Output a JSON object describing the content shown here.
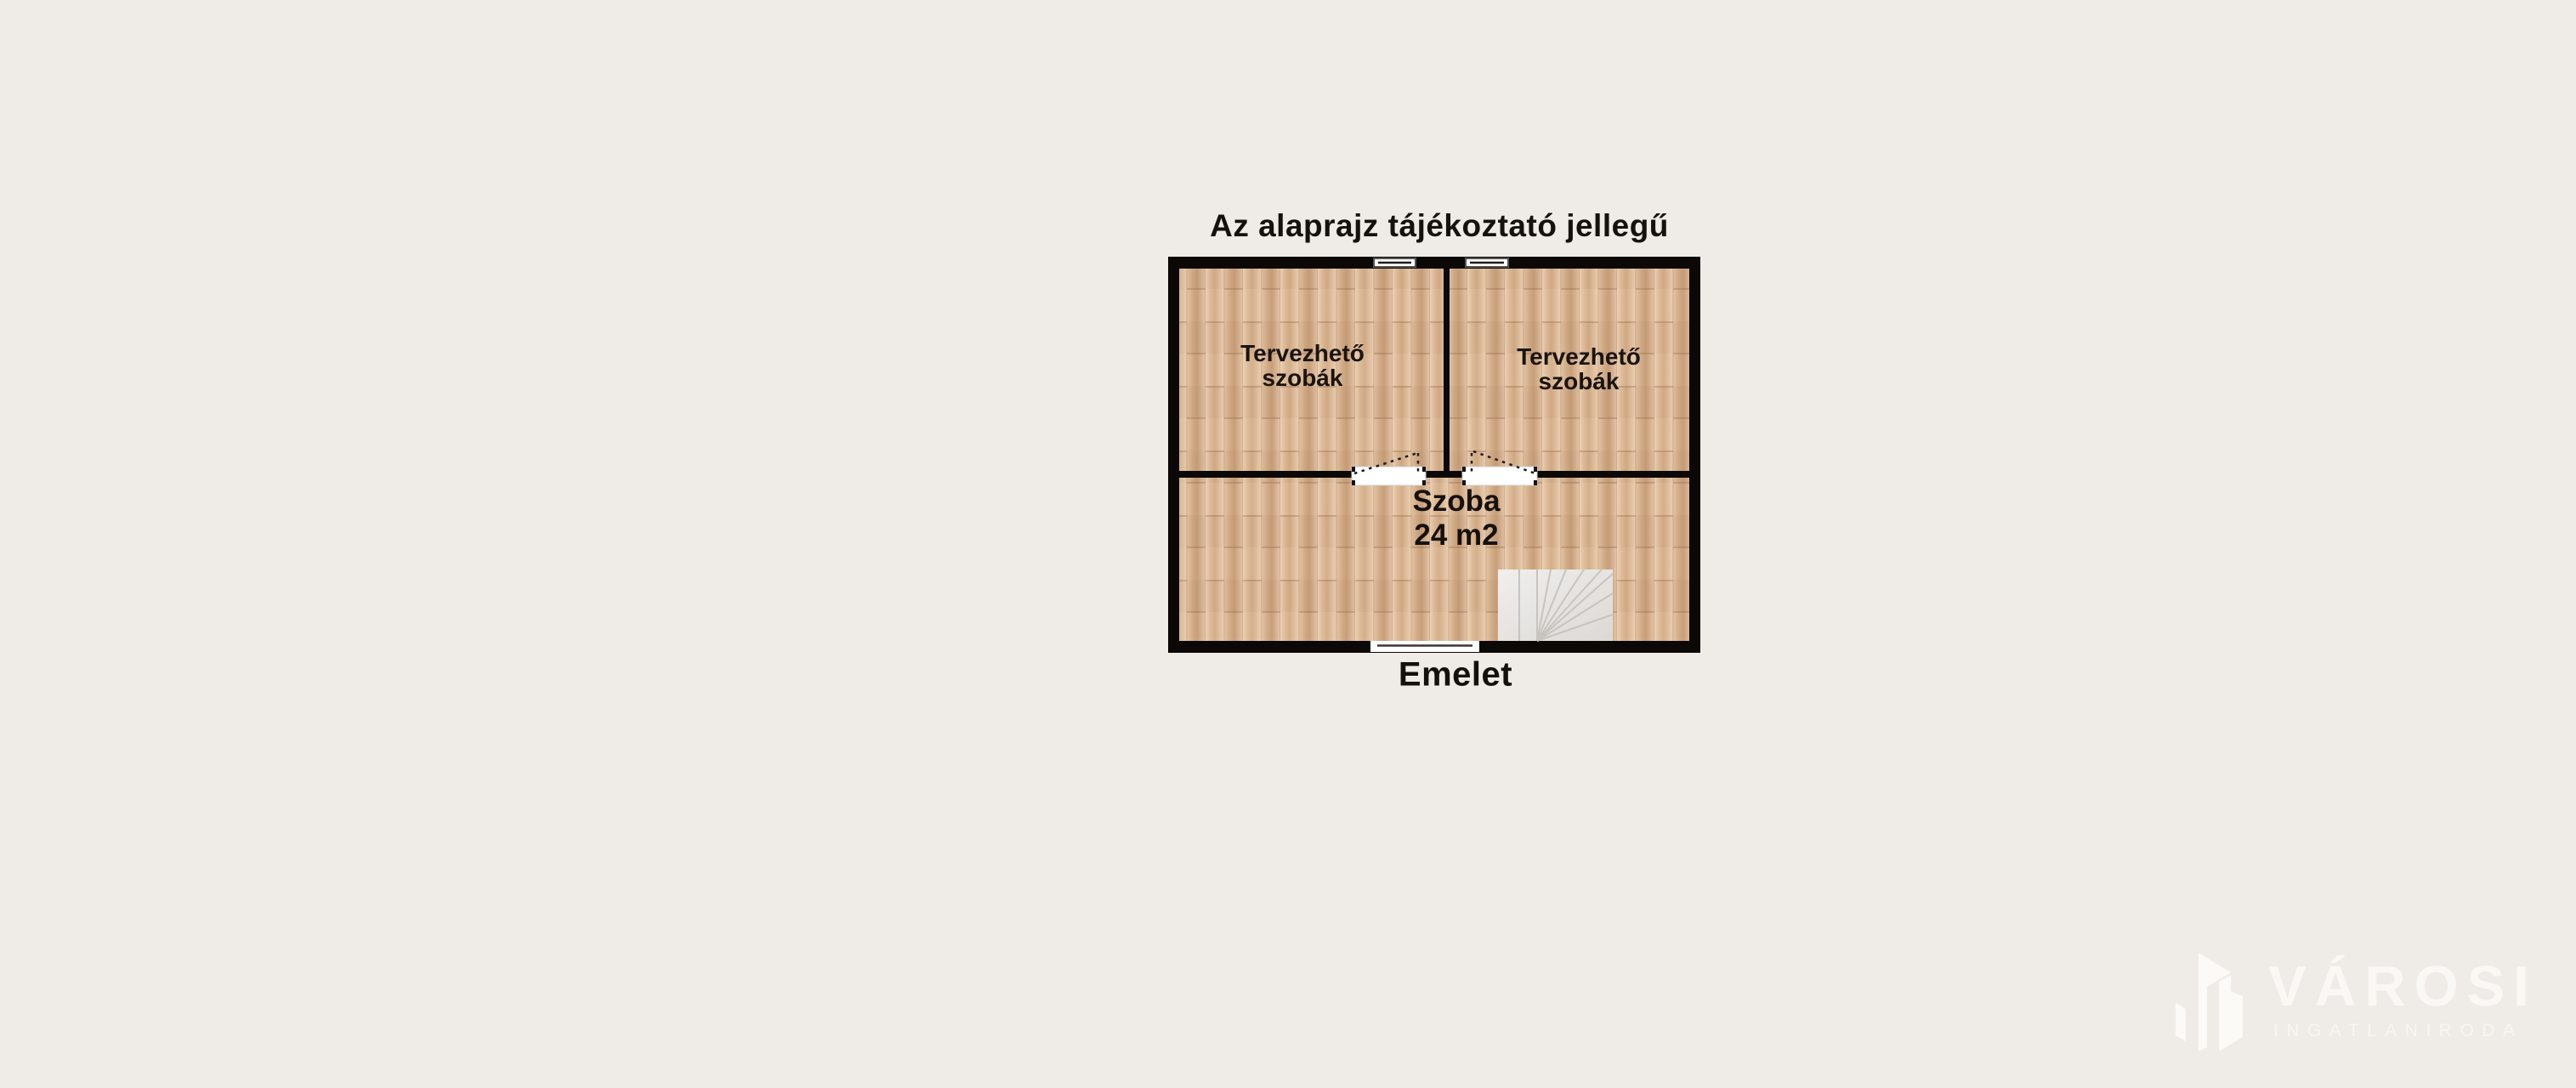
{
  "title": "Az alaprajz tájékoztató jellegű",
  "plan": {
    "floor_label": "Emelet",
    "room_top_left": {
      "line1": "Tervezhető",
      "line2": "szobák"
    },
    "room_top_right": {
      "line1": "Tervezhető",
      "line2": "szobák"
    },
    "room_bottom": {
      "line1": "Szoba",
      "line2": "24 m2"
    }
  },
  "watermark": {
    "brand": "VÁROSI",
    "tagline": "INGATLANIRODA"
  },
  "colors": {
    "background": "#efece8",
    "wall": "#0b0806",
    "floor_light": "#e7ccad",
    "floor_dark": "#cfa883",
    "text": "#16110d",
    "stairs_fill": "#eceae7",
    "watermark": "#faf8f4"
  }
}
